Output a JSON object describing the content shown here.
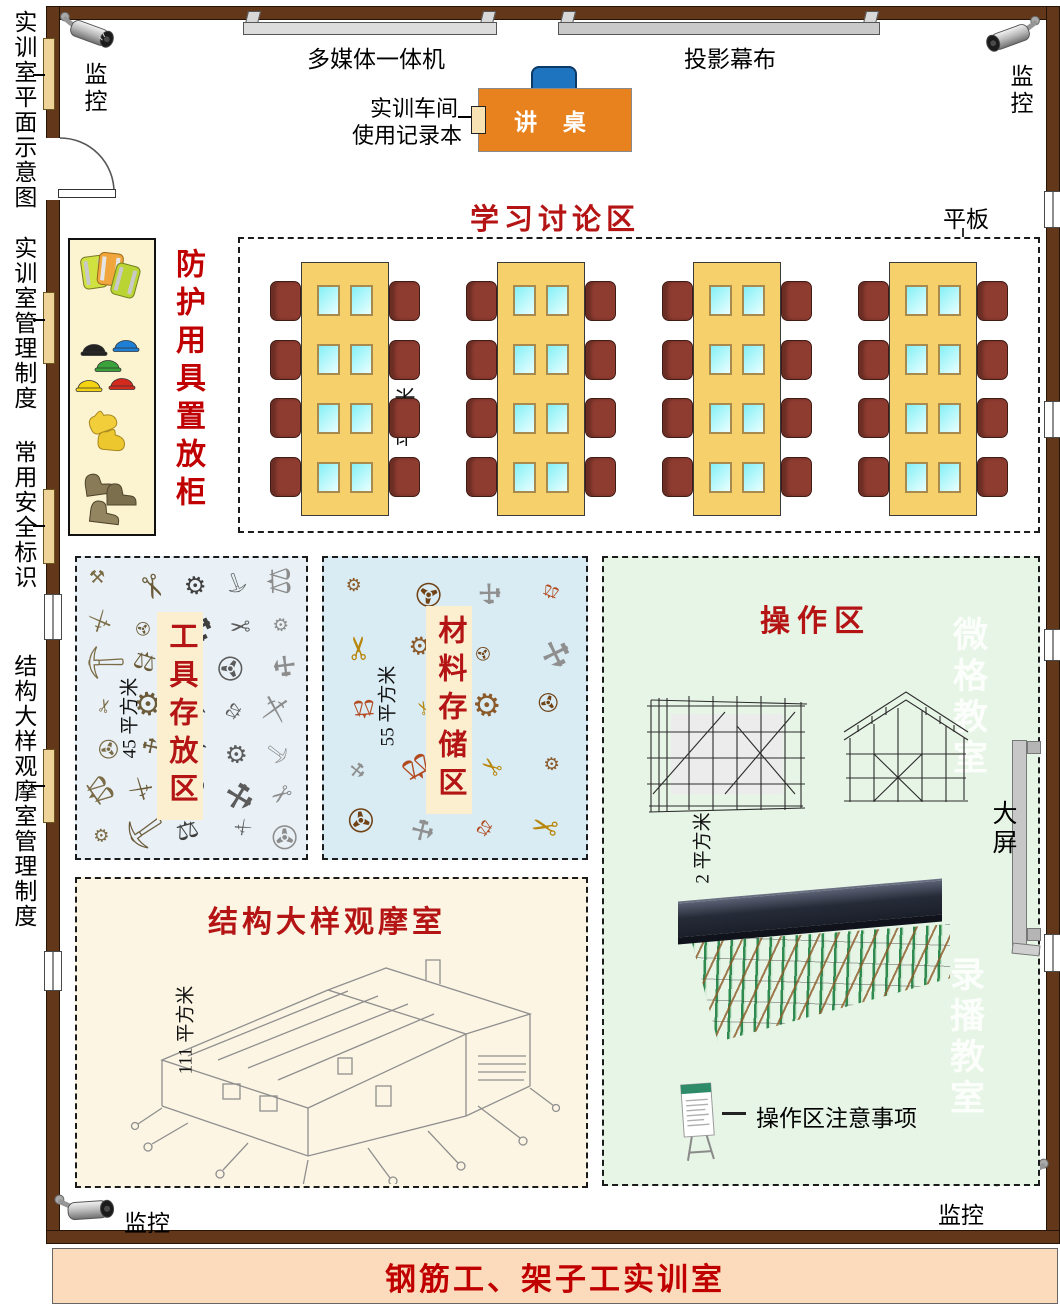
{
  "banner": {
    "title": "钢筋工、架子工实训室"
  },
  "outside": {
    "plan_title": "实训室平面示意图",
    "room_rules": "实训室管理制度",
    "safety_signs": "常用安全标识",
    "observation_rules": "结构大样观摩室管理制度"
  },
  "monitor": {
    "label": "监控"
  },
  "front_wall": {
    "multimedia": "多媒体一体机",
    "projector_screen": "投影幕布",
    "podium": "讲 桌",
    "logbook_line1": "实训车间",
    "logbook_line2": "使用记录本"
  },
  "discussion_area": {
    "title": "学习讨论区",
    "tablet_label": "平板",
    "area_label": "平方米",
    "layout": {
      "tables": 4,
      "chair_rows": 4,
      "tablet_rows": 4,
      "tablet_cols": 2
    }
  },
  "ppe_cabinet": {
    "title": "防护用具置放柜"
  },
  "tools_zone": {
    "title": "工具存放区",
    "area_label": "45 平方米",
    "scatter": {
      "glyphs": [
        "⚒",
        "✂",
        "⚙",
        "⛏",
        "⚖",
        "⚔",
        "✇"
      ],
      "colors": [
        "#5b5b5b",
        "#7a6a45",
        "#3f3f3f",
        "#8c8c8c",
        "#6b5b3a"
      ],
      "cols": 5,
      "rows": 7
    }
  },
  "materials_zone": {
    "title": "材料存储区",
    "area_label": "55 平方米",
    "scatter": {
      "glyphs": [
        "⚙",
        "✇",
        "⚒",
        "⚖",
        "✂"
      ],
      "colors": [
        "#b34a1f",
        "#8a5a2a",
        "#8f8f8f",
        "#b8860b",
        "#704214"
      ],
      "cols": 4,
      "rows": 5
    }
  },
  "operation_zone": {
    "title": "操作区",
    "area_label": "2 平方米",
    "notice_label": "操作区注意事项",
    "watermark_top": "微格教室",
    "watermark_bottom": "录播教室",
    "big_screen_label": "大屏"
  },
  "structure_zone": {
    "title": "结构大样观摩室",
    "area_label": "111 平方米"
  },
  "colors": {
    "accent_red": "#B41414",
    "title_red": "#C00000",
    "wall_brown": "#63381A",
    "table_yellow": "#F6D16B",
    "chair_maroon": "#8E3C30",
    "banner_bg": "#FBDBBB",
    "tools_bg": "#E9F1F6",
    "materials_bg": "#D9EBF3",
    "operation_bg": "#E7F5E6",
    "structure_bg": "#FCF5E3"
  }
}
